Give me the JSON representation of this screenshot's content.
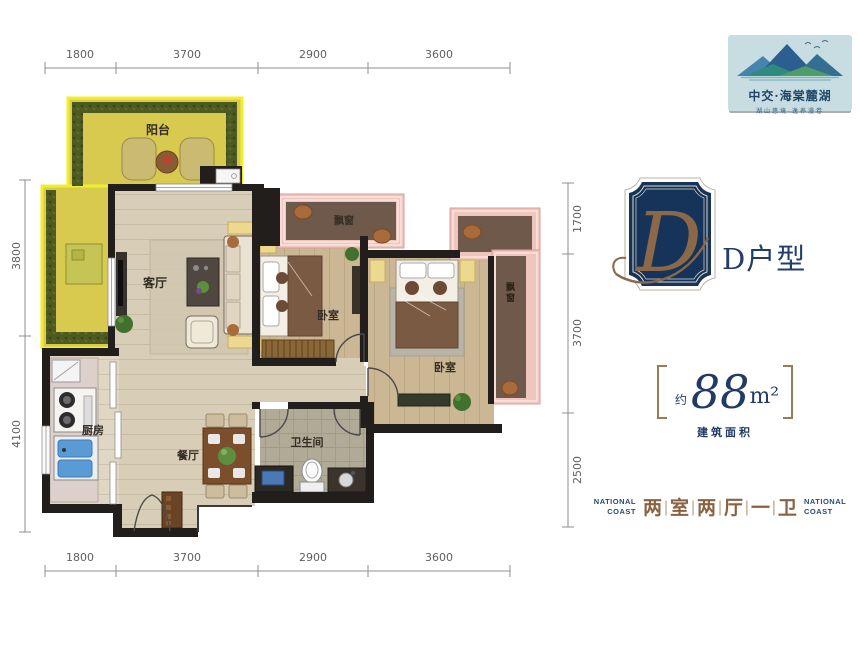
{
  "logo": {
    "brand": "中交·海棠麓湖",
    "tagline": "湖山悠境·逸养漫卷"
  },
  "emblem": {
    "letter": "D"
  },
  "title": {
    "name": "D户型"
  },
  "area": {
    "approx": "约",
    "value": "88",
    "unit": "m²",
    "caption": "建筑面积"
  },
  "summary": {
    "national_left": "NATIONAL COAST",
    "national_right": "NATIONAL COAST",
    "rooms": [
      "两",
      "室",
      "两",
      "厅",
      "一",
      "卫"
    ],
    "separator": "|"
  },
  "floorplan": {
    "labels": {
      "balcony": "阳台",
      "living": "客厅",
      "bedroom1": "卧室",
      "bedroom2": "卧室",
      "kitchen": "厨房",
      "dining": "餐厅",
      "bathroom": "卫生间",
      "bay1": "飘窗",
      "bay2": "飘窗"
    },
    "dimensions": {
      "top": [
        "1800",
        "3700",
        "2900",
        "3600"
      ],
      "bottom": [
        "1800",
        "3700",
        "2900",
        "3600"
      ],
      "left": [
        "3800",
        "4100"
      ],
      "right": [
        "1700",
        "3700",
        "2500"
      ]
    }
  },
  "colors": {
    "navy": "#213b66",
    "bronze": "#8a6848",
    "balcony_yellow": "#d8ca4e",
    "hedge_green": "#4d5b21",
    "bay_pink": "#efc6bd",
    "bay_brown": "#6f594a",
    "wall": "#211e1b",
    "logo_bg": "#c8dde2"
  }
}
